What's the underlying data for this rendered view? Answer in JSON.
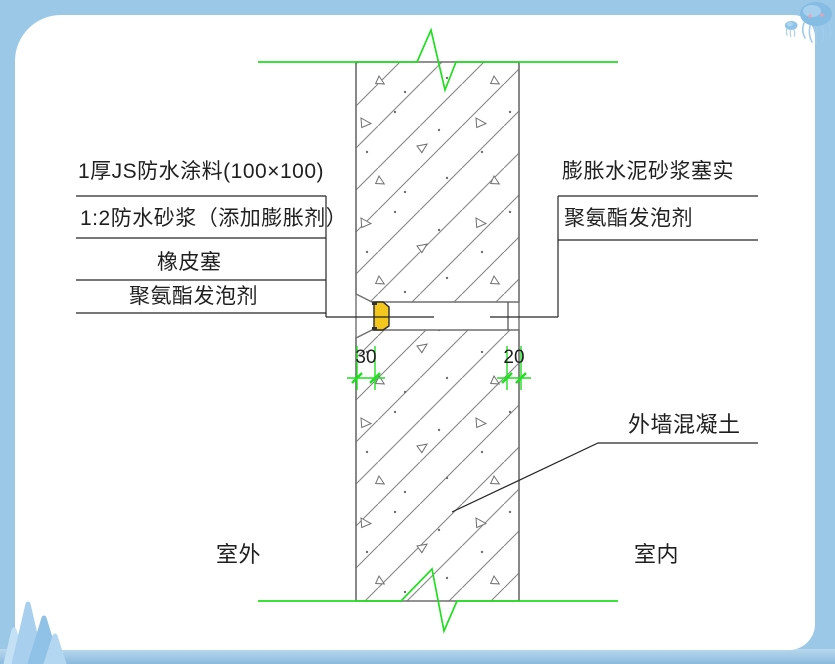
{
  "frame": {
    "border_color": "#9cc8e7",
    "decorations": [
      "jellyfish-top-right",
      "crystal-bottom-left"
    ]
  },
  "drawing": {
    "labels_left": [
      {
        "text": "1厚JS防水涂料(100×100)"
      },
      {
        "text": "1:2防水砂浆（添加膨胀剂）"
      },
      {
        "text": "橡皮塞"
      },
      {
        "text": "聚氨酯发泡剂"
      }
    ],
    "labels_right": [
      {
        "text": "膨胀水泥砂浆塞实"
      },
      {
        "text": "聚氨酯发泡剂"
      }
    ],
    "wall_label": "外墙混凝土",
    "room_labels": {
      "outdoor": "室外",
      "indoor": "室内"
    },
    "dimensions": [
      {
        "value": "30"
      },
      {
        "value": "20"
      }
    ],
    "colors": {
      "break_line_green": "#1fdf1f",
      "hatch_gray": "#858585",
      "wall_edge_gray": "#6f6f6f",
      "ink": "#262626",
      "plug_yellow": "#f3c71e"
    }
  }
}
